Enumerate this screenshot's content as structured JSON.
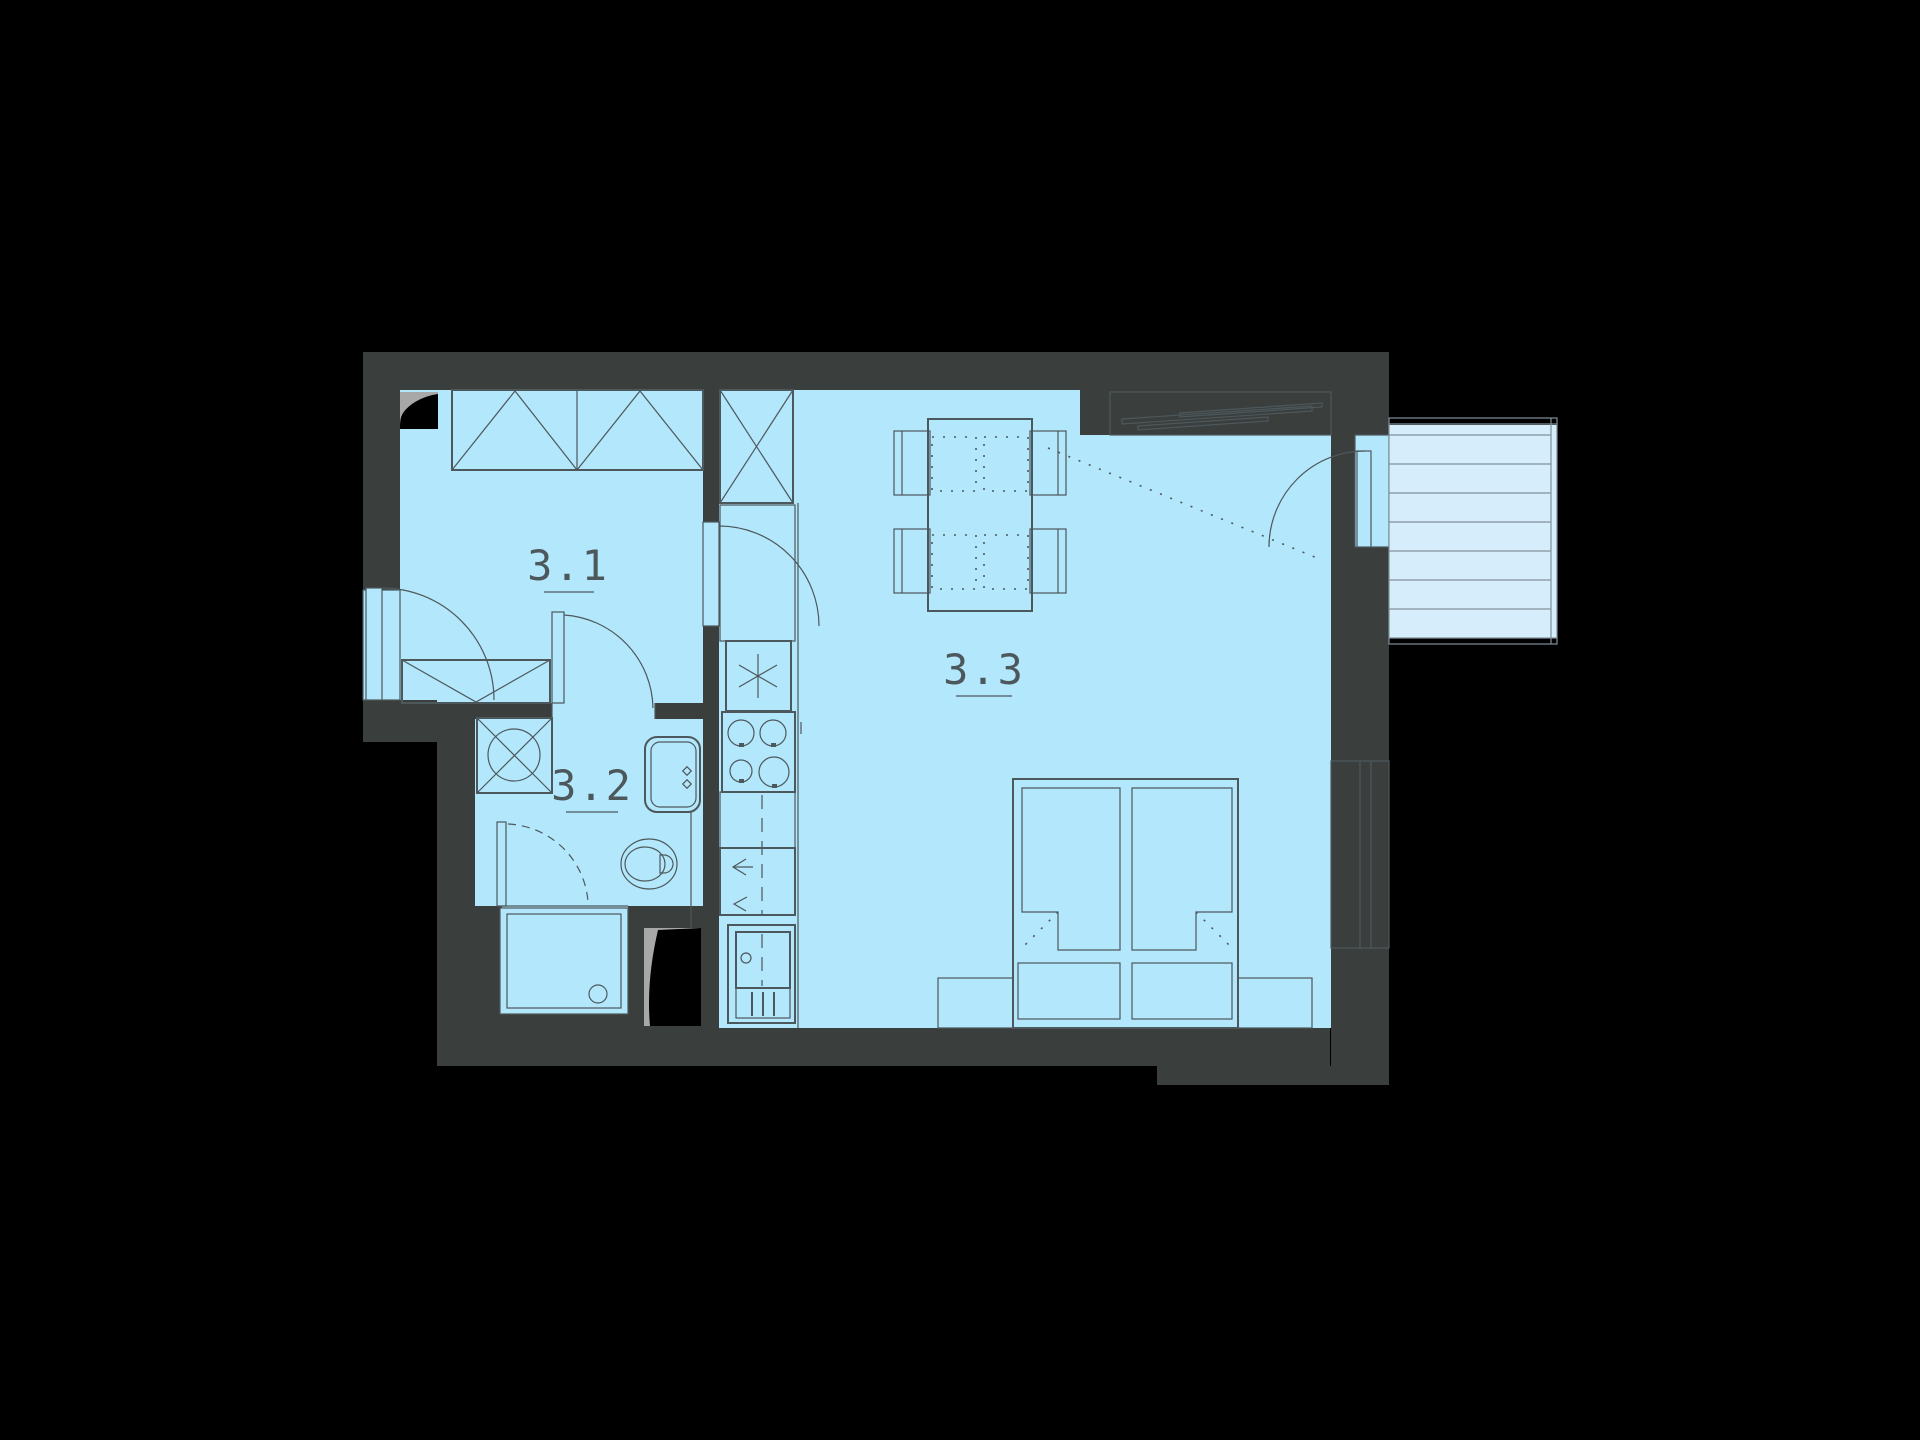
{
  "plan_title": "apartment unit floor plan",
  "rooms": [
    {
      "label": "3.1",
      "name": "hallway"
    },
    {
      "label": "3.2",
      "name": "bathroom"
    },
    {
      "label": "3.3",
      "name": "living-room-with-kitchen"
    }
  ],
  "colors": {
    "bg": "#000000",
    "wall": "#3a3e3d",
    "floor": "#b3e7fb",
    "balcony": "#d6eefb",
    "niche": "#cfeafa",
    "line": "#4d585c",
    "shaft-gray": "#a8a8a8",
    "shaft-black": "#000000",
    "thin": "#7f9099"
  },
  "furniture_icons": [
    "wardrobe-icon",
    "entrance-door-icon",
    "interior-door-icon",
    "tall-cabinet-icon",
    "fridge-icon",
    "cooktop-icon",
    "kitchen-sink-icon",
    "kitchen-base-unit-icon",
    "washing-machine-icon",
    "washbasin-icon",
    "toilet-icon",
    "shower-tray-icon",
    "shower-door-icon",
    "dining-table-icon",
    "chair-icon",
    "double-bed-icon",
    "bench-box-icon",
    "nightstand-icon",
    "window-icon",
    "balcony-door-icon",
    "balcony-deck-icon",
    "shaft-icon"
  ]
}
